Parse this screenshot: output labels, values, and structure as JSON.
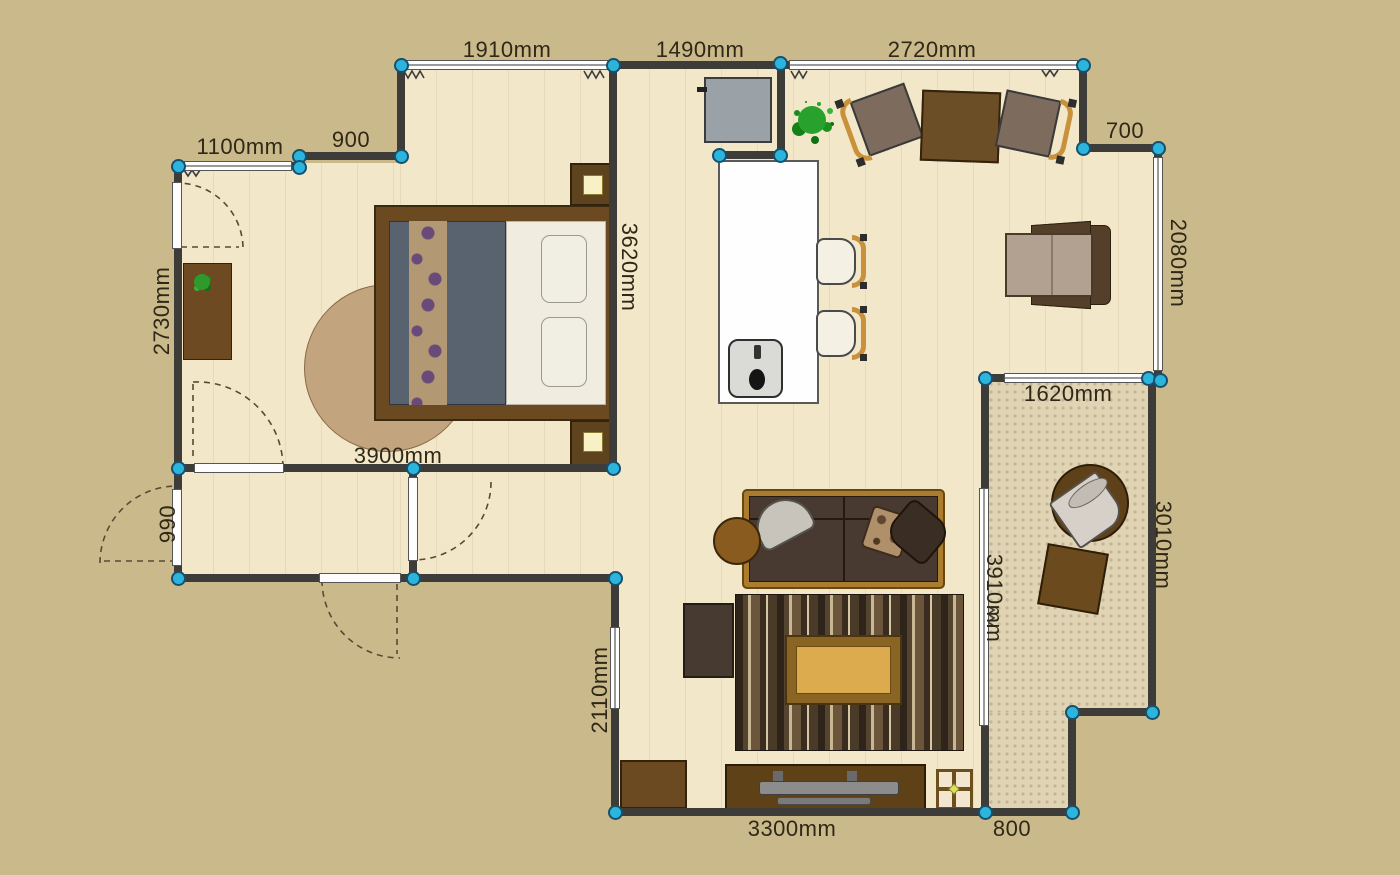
{
  "plan": {
    "colors": {
      "background": "#cab98a",
      "floor": "#f3e7c9",
      "balcony_floor": "#e0d4b4",
      "wall": "#3d3c38",
      "marker_fill": "#2cb5dc",
      "marker_border": "#17506e",
      "dimension_text": "#2f2817",
      "window_fill": "#ffffff",
      "door_swing_stroke": "#5a4836"
    },
    "labels": [
      {
        "text": "1910mm",
        "x": 507,
        "y": 50,
        "rot": 0
      },
      {
        "text": "1490mm",
        "x": 700,
        "y": 50,
        "rot": 0
      },
      {
        "text": "2720mm",
        "x": 932,
        "y": 50,
        "rot": 0
      },
      {
        "text": "1100mm",
        "x": 240,
        "y": 147,
        "rot": 0
      },
      {
        "text": "900",
        "x": 351,
        "y": 140,
        "rot": 0
      },
      {
        "text": "700",
        "x": 1125,
        "y": 131,
        "rot": 0
      },
      {
        "text": "2730mm",
        "x": 162,
        "y": 311,
        "rot": -90
      },
      {
        "text": "990",
        "x": 168,
        "y": 524,
        "rot": -90
      },
      {
        "text": "2110mm",
        "x": 600,
        "y": 690,
        "rot": -90
      },
      {
        "text": "3620mm",
        "x": 629,
        "y": 267,
        "rot": 90
      },
      {
        "text": "2080mm",
        "x": 1178,
        "y": 263,
        "rot": 90
      },
      {
        "text": "1620mm",
        "x": 1068,
        "y": 394,
        "rot": 0
      },
      {
        "text": "3010mm",
        "x": 1163,
        "y": 545,
        "rot": 90
      },
      {
        "text": "3910mm",
        "x": 994,
        "y": 598,
        "rot": 90
      },
      {
        "text": "3900mm",
        "x": 398,
        "y": 456,
        "rot": 0
      },
      {
        "text": "3300mm",
        "x": 792,
        "y": 829,
        "rot": 0
      },
      {
        "text": "800",
        "x": 1012,
        "y": 829,
        "rot": 0
      }
    ],
    "floors": [
      [
        400,
        65,
        213,
        513
      ],
      [
        177,
        163,
        223,
        415
      ],
      [
        613,
        65,
        469,
        313
      ],
      [
        1082,
        148,
        76,
        230
      ],
      [
        613,
        378,
        372,
        434
      ]
    ],
    "balcony_floors": [
      [
        989,
        382,
        159,
        330
      ],
      [
        989,
        712,
        83,
        100
      ]
    ],
    "walls": [
      [
        397,
        61,
        688,
        8
      ],
      [
        295,
        152,
        110,
        8
      ],
      [
        174,
        162,
        127,
        8
      ],
      [
        713,
        151,
        72,
        8
      ],
      [
        1079,
        144,
        82,
        8
      ],
      [
        982,
        374,
        180,
        8
      ],
      [
        174,
        464,
        443,
        8
      ],
      [
        174,
        574,
        445,
        8
      ],
      [
        612,
        808,
        464,
        8
      ],
      [
        1068,
        708,
        88,
        8
      ],
      [
        397,
        61,
        8,
        99
      ],
      [
        174,
        162,
        8,
        420
      ],
      [
        609,
        61,
        8,
        411
      ],
      [
        409,
        464,
        8,
        118
      ],
      [
        611,
        574,
        8,
        242
      ],
      [
        1079,
        61,
        8,
        91
      ],
      [
        777,
        61,
        8,
        96
      ],
      [
        1154,
        144,
        8,
        238
      ],
      [
        1148,
        374,
        8,
        342
      ],
      [
        981,
        374,
        8,
        442
      ],
      [
        1068,
        708,
        8,
        108
      ]
    ],
    "windows": [
      [
        404,
        60,
        207,
        10
      ],
      [
        789,
        60,
        289,
        10
      ],
      [
        184,
        161,
        108,
        10
      ],
      [
        1153,
        157,
        10,
        214
      ],
      [
        1004,
        373,
        142,
        10
      ],
      [
        610,
        627,
        10,
        82
      ],
      [
        979,
        488,
        10,
        238
      ]
    ],
    "doors": [
      [
        172,
        182,
        10,
        67
      ],
      [
        172,
        489,
        10,
        77
      ],
      [
        194,
        463,
        90,
        10
      ],
      [
        408,
        477,
        10,
        84
      ],
      [
        319,
        573,
        82,
        10
      ]
    ],
    "markers": [
      [
        401,
        65
      ],
      [
        613,
        65
      ],
      [
        780,
        63
      ],
      [
        1083,
        65
      ],
      [
        719,
        155
      ],
      [
        780,
        155
      ],
      [
        1083,
        148
      ],
      [
        1158,
        148
      ],
      [
        178,
        166
      ],
      [
        299,
        156
      ],
      [
        299,
        167
      ],
      [
        401,
        156
      ],
      [
        178,
        468
      ],
      [
        413,
        468
      ],
      [
        613,
        468
      ],
      [
        178,
        578
      ],
      [
        413,
        578
      ],
      [
        615,
        578
      ],
      [
        615,
        812
      ],
      [
        985,
        812
      ],
      [
        1072,
        812
      ],
      [
        1072,
        712
      ],
      [
        1152,
        712
      ],
      [
        1148,
        378
      ],
      [
        1160,
        380
      ],
      [
        985,
        378
      ]
    ],
    "door_swings": [
      "M243 247 A66 66 0 0 0 179 183",
      "M181 247 L239 247",
      "M100 563 A77 77 0 0 1 177 486",
      "M104 561 L173 561",
      "M193 382 A86 86 0 0 1 283 466",
      "M193 384 L193 460",
      "M491 482 A78 78 0 0 1 413 560",
      "M322 580 A78 78 0 0 0 400 658",
      "M397 584 L397 654"
    ],
    "radiator_marks": [
      "M404 71 l4 7 4 -7 4 7 4 -7 4 7",
      "M584 71 l4 7 4 -7 4 7 4 -7 4 7",
      "M184 170 l4 6 4 -6 4 6 4 -6",
      "M791 71 l4 7 4 -7 4 7 4 -7",
      "M1042 70 l4 6 4 -6 4 6 4 -6",
      "M988 606 l6 4 -6 4 6 4 -6 4 6 4"
    ],
    "furniture": [
      "round-rug",
      "console-desk",
      "potted-plant-small",
      "double-bed",
      "nightstand",
      "table-lamp",
      "refrigerator",
      "kitchen-island",
      "kitchen-sink",
      "bar-stool",
      "dining-chair",
      "dining-table",
      "potted-plant",
      "lounge-armchair",
      "sofa",
      "throw-pillow",
      "round-side-table",
      "striped-area-rug",
      "coffee-table",
      "media-cabinet",
      "storage-cabinet",
      "tv-stand",
      "floor-lamp",
      "balcony-tub-chair",
      "balcony-ottoman"
    ]
  }
}
